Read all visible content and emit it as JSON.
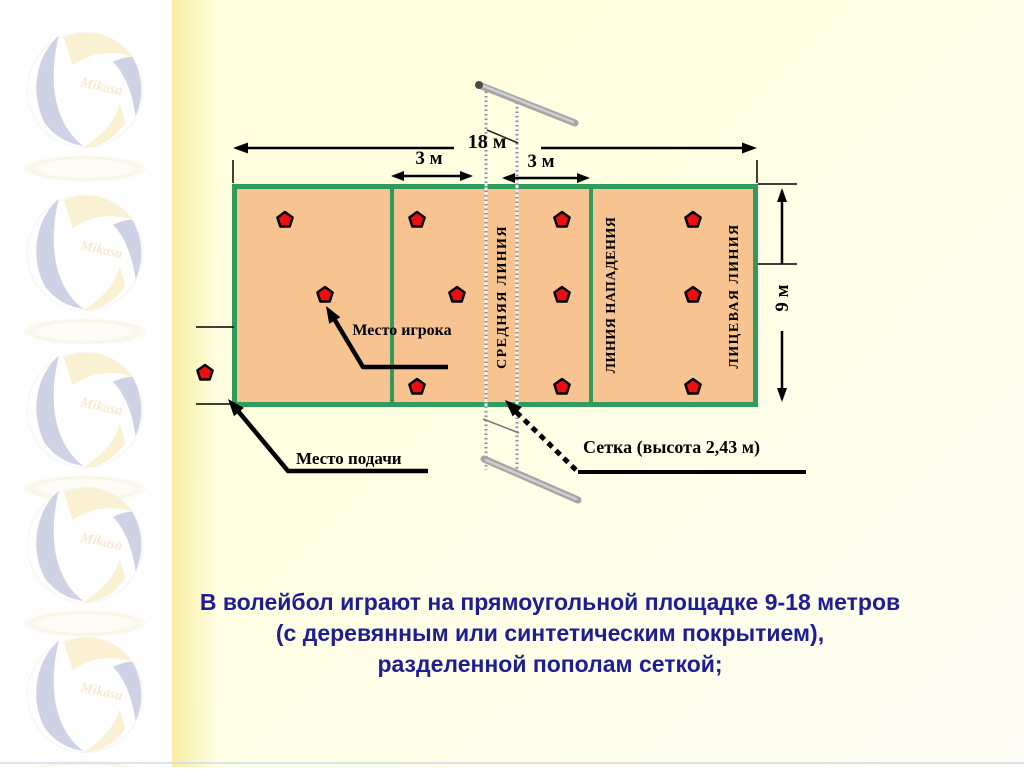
{
  "slide": {
    "watermark": {
      "brand": "Mikasa",
      "count": 5
    },
    "diagram": {
      "dimensions": {
        "court_width": "18 м",
        "attack_zone_left": "3 м",
        "attack_zone_right": "3 м",
        "court_height": "9 м"
      },
      "line_labels": {
        "center_line": "СРЕДНЯЯ ЛИНИЯ",
        "attack_line": "ЛИНИЯ НАПАДЕНИЯ",
        "end_line": "ЛИЦЕВАЯ ЛИНИЯ"
      },
      "callouts": {
        "player_spot": "Место игрока",
        "serve_spot": "Место подачи",
        "net": "Сетка (высота 2,43 м)"
      },
      "players": {
        "marker_color": "#eb0f0f",
        "positions": [
          [
            285,
            220
          ],
          [
            417,
            220
          ],
          [
            325,
            295
          ],
          [
            457,
            295
          ],
          [
            417,
            387
          ],
          [
            562,
            220
          ],
          [
            693,
            220
          ],
          [
            562,
            295
          ],
          [
            693,
            295
          ],
          [
            562,
            387
          ],
          [
            693,
            387
          ],
          [
            205,
            373
          ]
        ]
      },
      "colors": {
        "court_fill": "#f6c391",
        "court_line": "#319b5d",
        "caption_text": "#1d1d94"
      }
    },
    "caption": {
      "line1": "В волейбол играют на прямоугольной площадке 9-18 метров",
      "line2": "(с деревянным или синтетическим покрытием),",
      "line3": "разделенной пополам сеткой;"
    }
  }
}
